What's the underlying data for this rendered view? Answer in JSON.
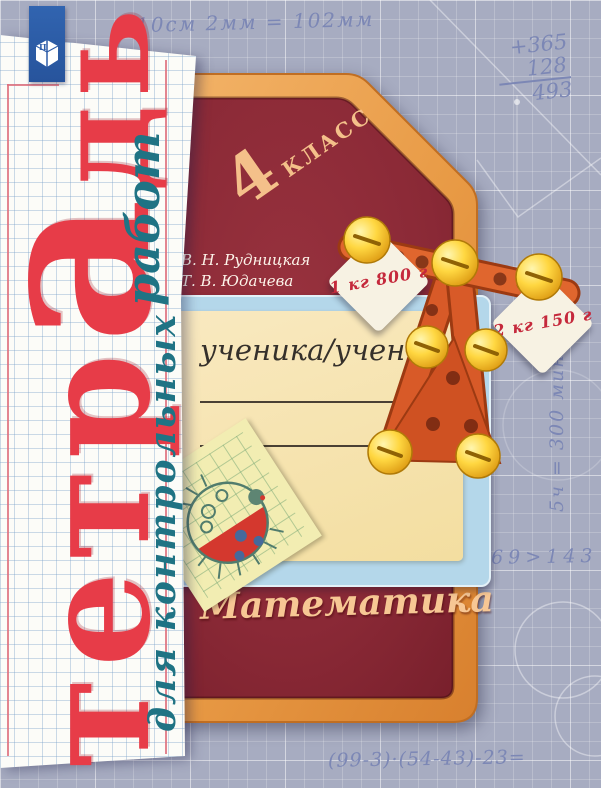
{
  "publisher": {
    "logo_letter": "П"
  },
  "handwritten_notes": {
    "top": "10см 2мм = 102мм",
    "addition": {
      "line1": "+365",
      "line2": "128",
      "line3": "493"
    },
    "vertical_right": "5ч = 300 мин",
    "comparison": "469>143",
    "bottom_equation": "(99-3)·(54-43)-23="
  },
  "title": {
    "part1": "тетр",
    "part2": "а",
    "part3": "дь",
    "subtitle_for": "для контрольных",
    "subtitle_works": "работ"
  },
  "grade": {
    "number": "4",
    "word": "КЛАСС"
  },
  "authors": {
    "author1": "В. Н. Рудницкая",
    "author2": "Т. В. Юдачева"
  },
  "subject_label": "Математика",
  "student_card": {
    "label": "ученика/ученицы"
  },
  "weight_tags": {
    "left": "1 кг 800 г",
    "right": "2 кг 150 г"
  },
  "colors": {
    "background": "#a7acc1",
    "board": "#8d2a35",
    "frame": "#e89a45",
    "title_red": "#e73c48",
    "subtitle_teal": "#1f7384",
    "ribbon_blue": "#2d5ca8",
    "notes_blue": "#7c87b5",
    "card_yellow": "#f6e4ac",
    "card_blue": "#b4d7ea",
    "tag_text_red": "#c5293c"
  }
}
